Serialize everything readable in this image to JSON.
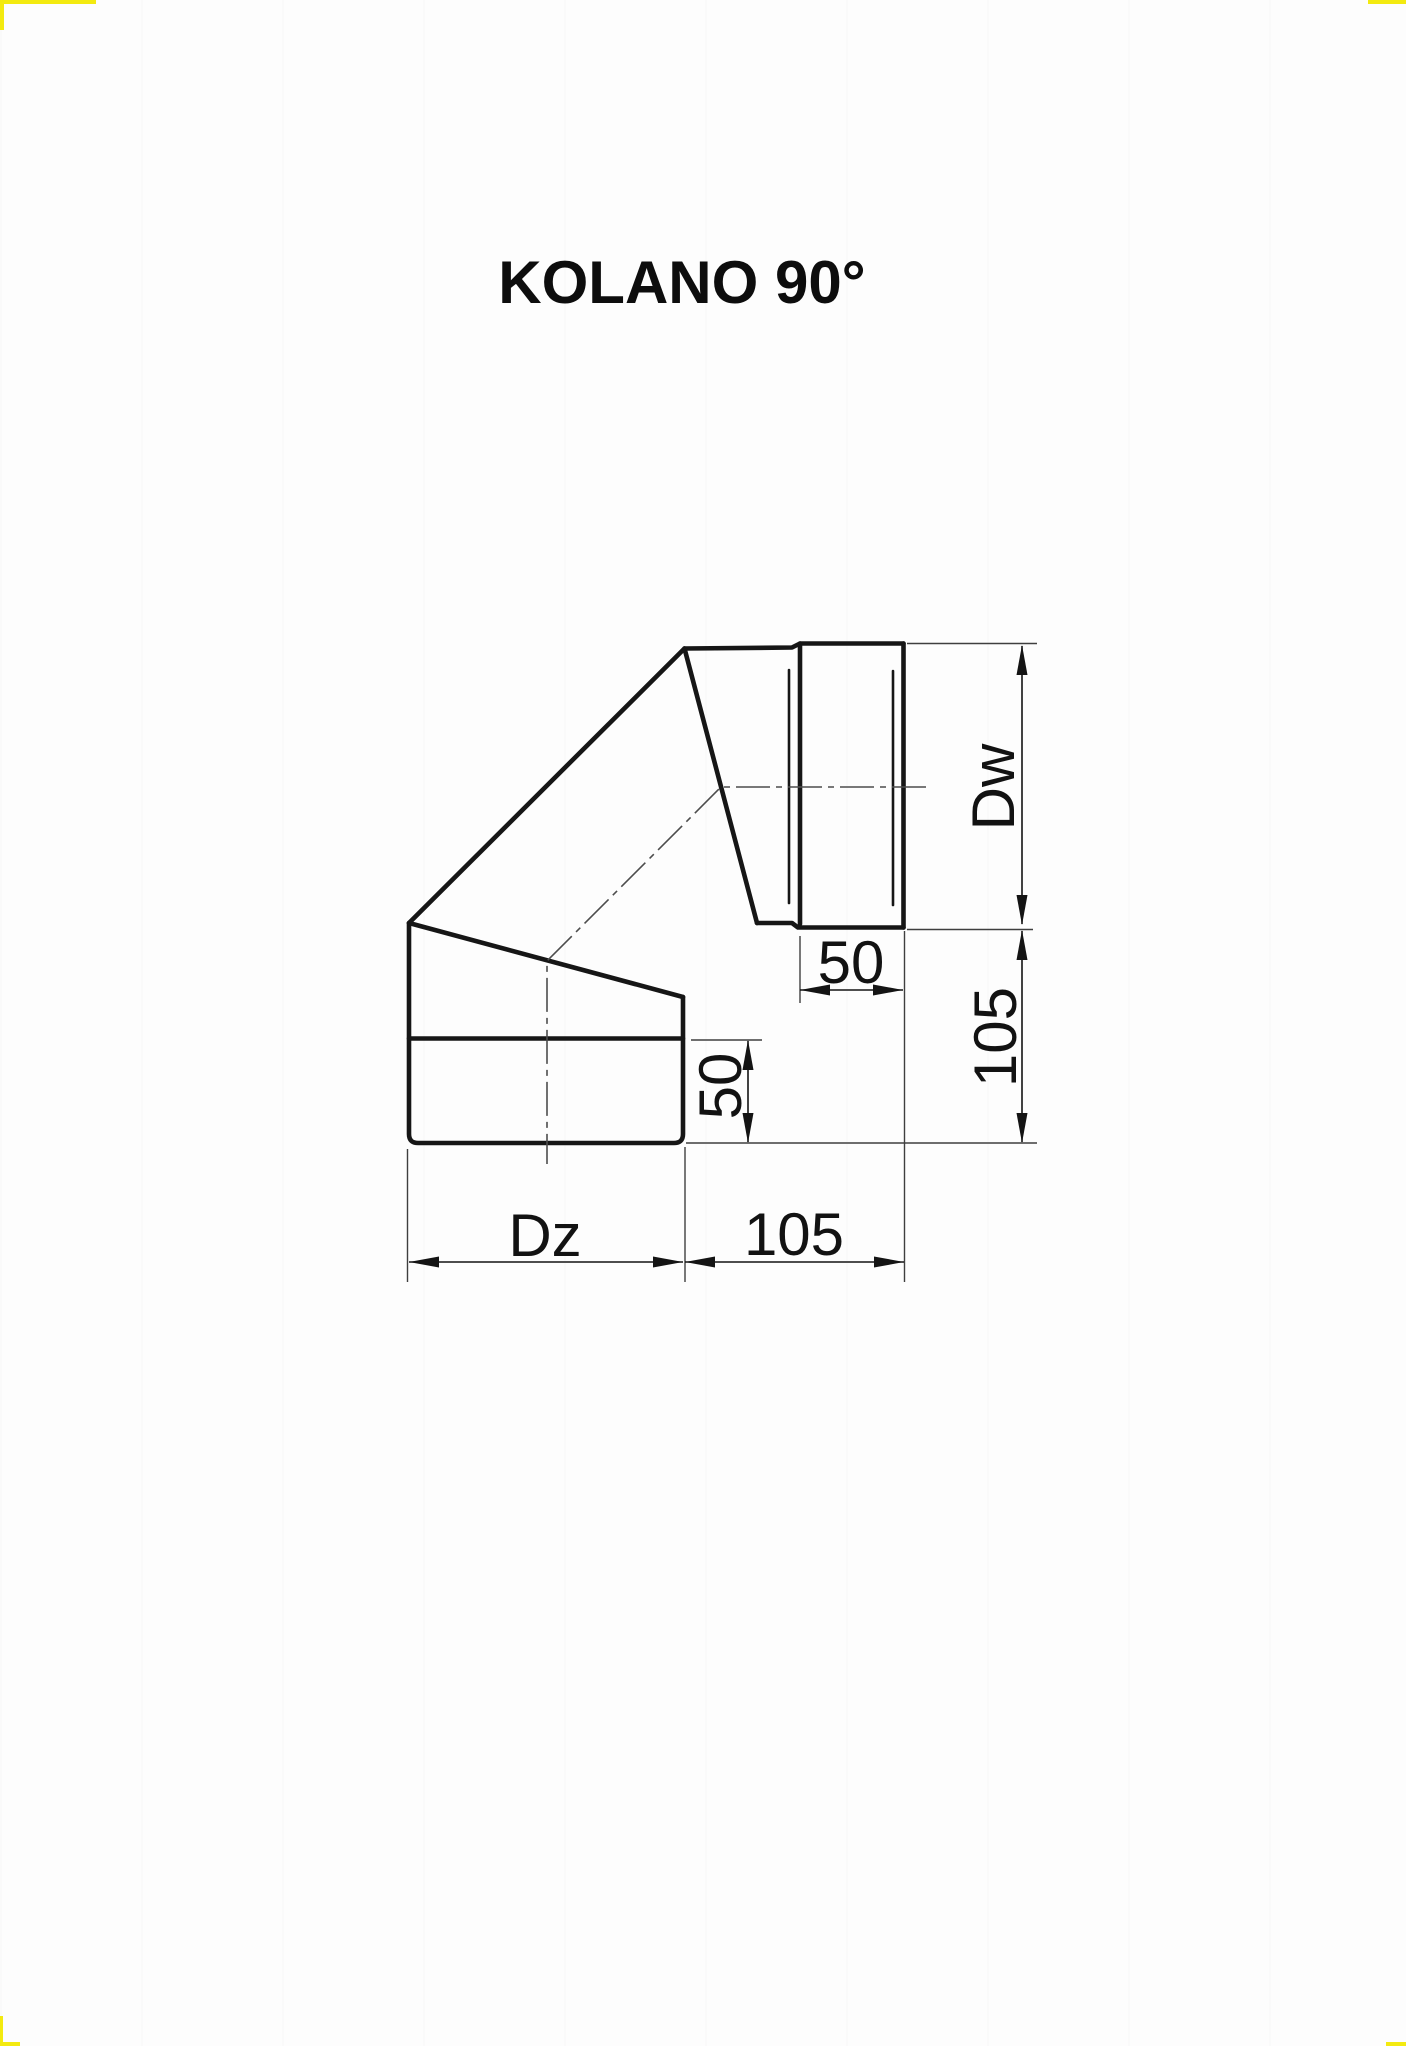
{
  "title": "KOLANO 90°",
  "page": {
    "background": "#fdfdfd",
    "corner_mark_color": "#f3ea10"
  },
  "drawing": {
    "type": "technical-drawing",
    "line_color": "#161616",
    "dimensions": {
      "inner_diameter_label": "Dw",
      "outer_diameter_label": "Dz",
      "socket_depth_label": "50",
      "lower_section_label": "50",
      "right_height_label": "105",
      "bottom_length_label": "105"
    }
  }
}
